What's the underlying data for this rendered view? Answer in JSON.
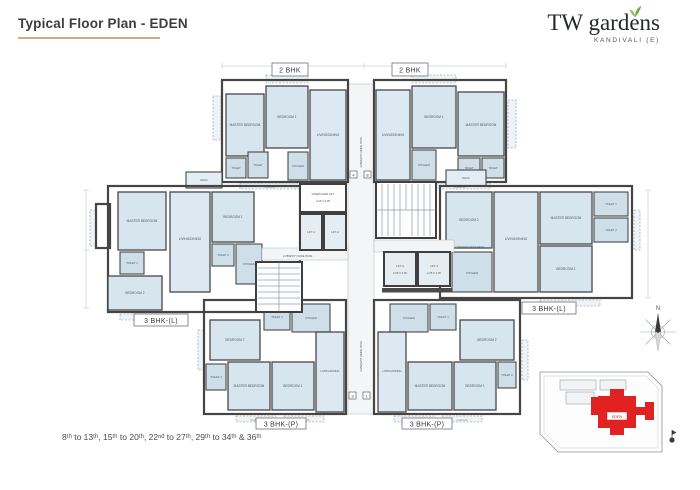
{
  "header": {
    "title": "Typical Floor Plan - EDEN"
  },
  "logo": {
    "brand": "TW gardens",
    "location": "KANDIVALI (E)"
  },
  "footer": {
    "floors": "8ᵗʰ to 13ᵗʰ, 15ᵗʰ to 20ᵗʰ, 22ⁿᵈ to 27ᵗʰ, 29ᵗʰ to 34ᵗʰ & 36ᵗʰ"
  },
  "plan": {
    "unit_labels": {
      "top_left": "2 BHK",
      "top_right": "2 BHK",
      "mid_left": "3 BHK-(L)",
      "mid_right": "3 BHK-(L)",
      "bottom_left": "3 BHK-(P)",
      "bottom_right": "3 BHK-(P)"
    },
    "rooms": {
      "master_bedroom": "MASTER BEDROOM",
      "bedroom1": "BEDROOM 1",
      "bedroom2": "BEDROOM 2",
      "living_dining": "LIVING/DINING",
      "kitchen": "KITCHEN",
      "toilet": "TOILET",
      "toilet1": "TOILET 1",
      "toilet2": "TOILET 2",
      "deck": "DECK",
      "chajja": "CHAJJA"
    },
    "core": {
      "stretcher": "STRETCHER LIFT",
      "stretcher_dim": "2.05 X 2.05",
      "lift1": "LIFT-1",
      "lift2": "LIFT-2",
      "lift3": "LIFT-3",
      "lift4": "LIFT-4",
      "lift_dim": "2.05 X 2.05",
      "pass_v": "3.05M(10'0\") WIDE PASS.",
      "pass_h": "2.05M(6'9\") WIDE PASS.",
      "m4": "4",
      "m8": "8",
      "m3": "3",
      "m1": "1"
    }
  },
  "keyplan": {
    "building": "EDEN",
    "north": "N"
  },
  "colors": {
    "room_fill": "#d7e5ef",
    "wall": "#474747",
    "accent_underline": "#c8b184",
    "highlight_red": "#e02222",
    "leaf_green": "#6fae3f"
  }
}
